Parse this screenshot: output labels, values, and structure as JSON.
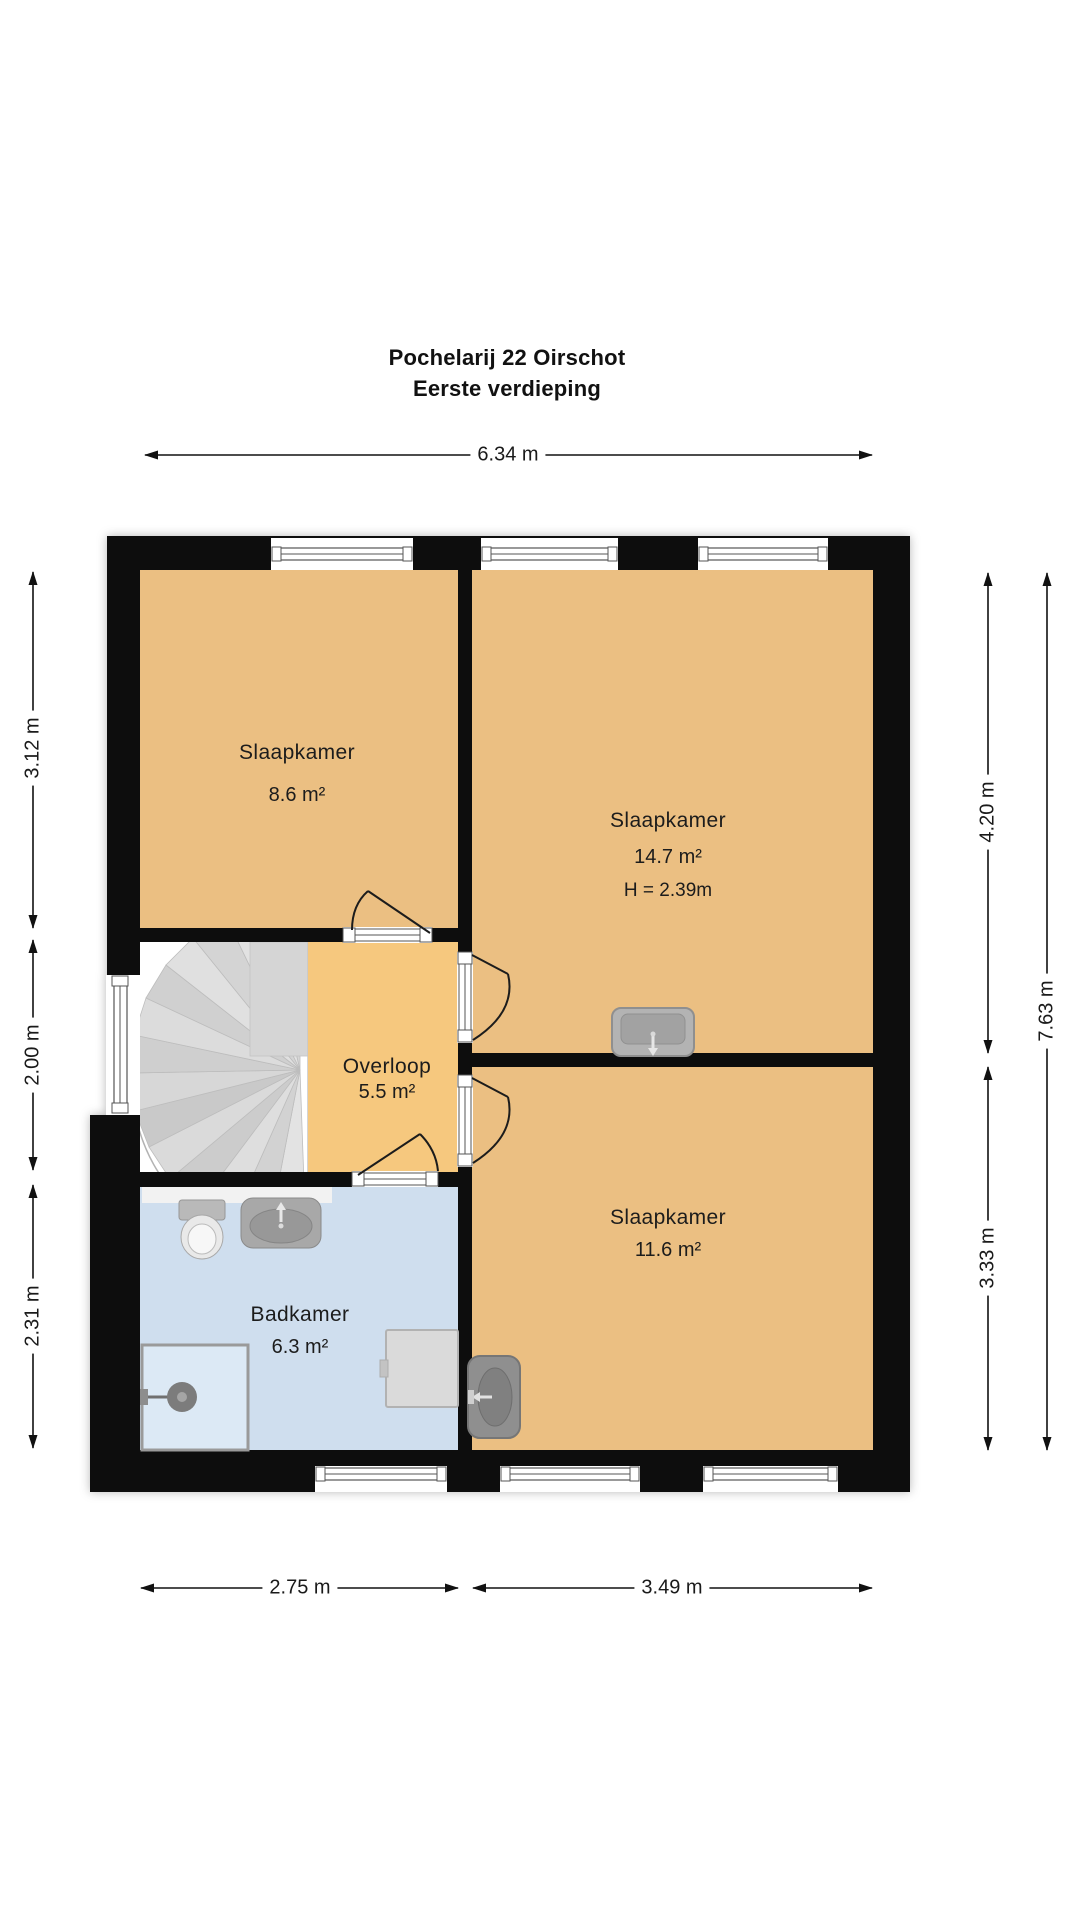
{
  "title": {
    "line1": "Pochelarij 22 Oirschot",
    "line2": "Eerste verdieping"
  },
  "rooms": [
    {
      "id": "slaapkamer-links",
      "name": "Slaapkamer",
      "area": "8.6 m²"
    },
    {
      "id": "slaapkamer-groot",
      "name": "Slaapkamer",
      "area": "14.7 m²",
      "ceiling_height": "H = 2.39m"
    },
    {
      "id": "overloop",
      "name": "Overloop",
      "area": "5.5 m²"
    },
    {
      "id": "badkamer",
      "name": "Badkamer",
      "area": "6.3 m²"
    },
    {
      "id": "slaapkamer-onder",
      "name": "Slaapkamer",
      "area": "11.6 m²"
    }
  ],
  "dimensions": {
    "top": "6.34 m",
    "left_top": "3.12 m",
    "left_middle": "2.00 m",
    "left_bottom": "2.31 m",
    "right_top": "4.20 m",
    "right_full": "7.63 m",
    "right_bottom": "3.33 m",
    "bottom_left": "2.75 m",
    "bottom_right": "3.49 m"
  },
  "fixtures": [
    "spiral-staircase",
    "toilet",
    "washbasin",
    "shower",
    "washing-machine",
    "bedroom-sink",
    "bedroom-sink-small"
  ],
  "colors": {
    "wall": "#101010",
    "bedroom_floor": "#ebbf82",
    "hall_floor": "#f6c87e",
    "bathroom_floor": "#cfdeee",
    "shower_floor": "#dce9f5",
    "stairs_tread": "#d8d8d8",
    "dimension_text": "#1a1a1a"
  }
}
